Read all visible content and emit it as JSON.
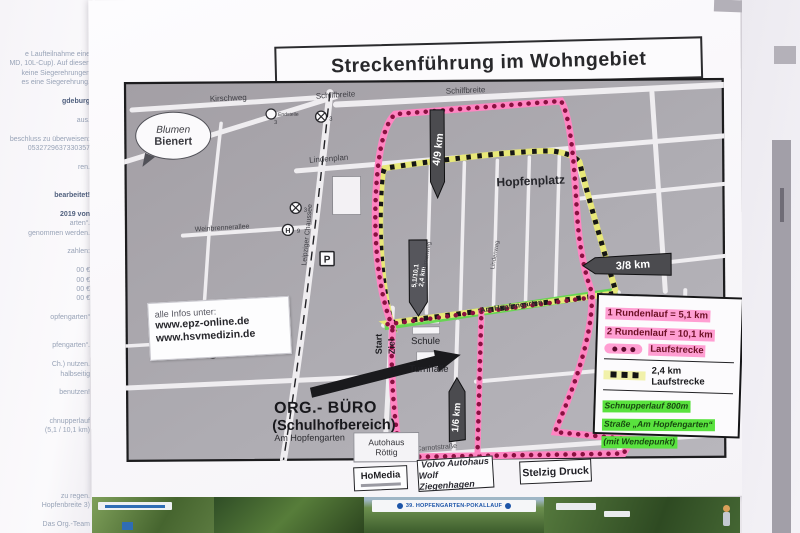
{
  "left_paper": {
    "fragments": [
      {
        "t": "e Laufteilnahme eine"
      },
      {
        "t": "MD, 10L-Cup). Auf diesen"
      },
      {
        "t": "keine Siegerehrungen"
      },
      {
        "t": "es eine Siegerehrung."
      },
      {
        "t": ""
      },
      {
        "t": "gdeburg",
        "b": true
      },
      {
        "t": ""
      },
      {
        "t": "aus."
      },
      {
        "t": ""
      },
      {
        "t": "beschluss zu überweisen:"
      },
      {
        "t": "0532729637330357"
      },
      {
        "t": ""
      },
      {
        "t": "ren."
      },
      {
        "t": ""
      },
      {
        "t": ""
      },
      {
        "t": "bearbeitet!",
        "b": true
      },
      {
        "t": ""
      },
      {
        "t": "2019 von",
        "b": true
      },
      {
        "t": "arten“."
      },
      {
        "t": "genommen werden."
      },
      {
        "t": ""
      },
      {
        "t": "zahlen:"
      },
      {
        "t": ""
      },
      {
        "t": "00 €"
      },
      {
        "t": "00 €"
      },
      {
        "t": "00 €"
      },
      {
        "t": "00 €"
      },
      {
        "t": ""
      },
      {
        "t": "opfengarten“"
      },
      {
        "t": ""
      },
      {
        "t": ""
      },
      {
        "t": "pfengarten“."
      },
      {
        "t": ""
      },
      {
        "t": "Ch.) nutzen."
      },
      {
        "t": "halbseitig"
      },
      {
        "t": ""
      },
      {
        "t": "benutzen!"
      },
      {
        "t": ""
      },
      {
        "t": ""
      },
      {
        "t": "chnupperlauf"
      },
      {
        "t": "(5,1 / 10,1 km)"
      },
      {
        "t": ""
      },
      {
        "t": ""
      },
      {
        "t": ""
      },
      {
        "t": ""
      },
      {
        "t": ""
      },
      {
        "t": ""
      },
      {
        "t": "zu regen."
      },
      {
        "t": "Hopfenbreite 3)"
      },
      {
        "t": ""
      },
      {
        "t": "Das Org.-Team"
      }
    ]
  },
  "poster": {
    "title": "Streckenführung im Wohngebiet",
    "info_box": {
      "l1": "alle Infos unter:",
      "l2": "www.epz-online.de",
      "l3": "www.hsvmedizin.de"
    },
    "bubble": {
      "l1": "Blumen",
      "l2": "Bienert"
    },
    "org": {
      "l1": "ORG.- BÜRO",
      "l2": "(Schulhofbereich)",
      "l3": "Am Hopfengarten"
    },
    "streets": {
      "kirschweg": "Kirschweg",
      "schilfbreite": "Schilfbreite",
      "lindenplan": "Lindenplan",
      "weinbrennerallee": "Weinbrennerallee",
      "leipziger": "Leipziger Chaussee",
      "am_hopfengarten": "Am Hopfengarten",
      "carnotstrasse": "Carnotstraße",
      "birnenweg": "Birnenweg",
      "lindenweg": "Lindenweg"
    },
    "places": {
      "hopfenplatz": "Hopfenplatz",
      "schule": "Schule",
      "turnhalle": "Turnhalle",
      "autohaus_l1": "Autohaus",
      "autohaus_l2": "Röttig",
      "endstelle": "Endstelle",
      "endstelle_nr": "3",
      "tram_nr": "3",
      "bus_h": "H",
      "bus_nr": "9",
      "parking": "P",
      "start": "Start",
      "ziel": "Ziel"
    },
    "markers": {
      "k49": "4/9 km",
      "k38": "3/8 km",
      "k16": "1/6 km",
      "k27": "2/7 km",
      "k51a": "5,1/10,1",
      "k51b": "2,4 km"
    },
    "legend": {
      "r1": "1 Rundenlauf = 5,1 km",
      "r2": "2 Rundenlauf = 10,1 km",
      "r3": "Laufstrecke",
      "r4a": "2,4 km",
      "r4b": "Laufstrecke",
      "r5a": "Schnupperlauf 800m",
      "r5b": "Straße „Am Hopfengarten“",
      "r5c": "(mit Wendepunkt)"
    },
    "sponsors": {
      "s1": "HoMedia",
      "s2a": "Volvo Autohaus",
      "s2b": "Wolf Ziegenhagen",
      "s3": "Stelzig Druck"
    }
  },
  "photos": {
    "banner": "39. HOPFENGARTEN-POKALLAUF"
  },
  "colors": {
    "route_pink": "#ff85c2",
    "route_dot": "#8a1040",
    "route_yellow": "#e8e878",
    "route_green": "#5fd84a",
    "legend_pink_highlight": "#ff9ed2",
    "legend_green_highlight": "#59e23e",
    "map_gray": "#aaa8ad"
  }
}
